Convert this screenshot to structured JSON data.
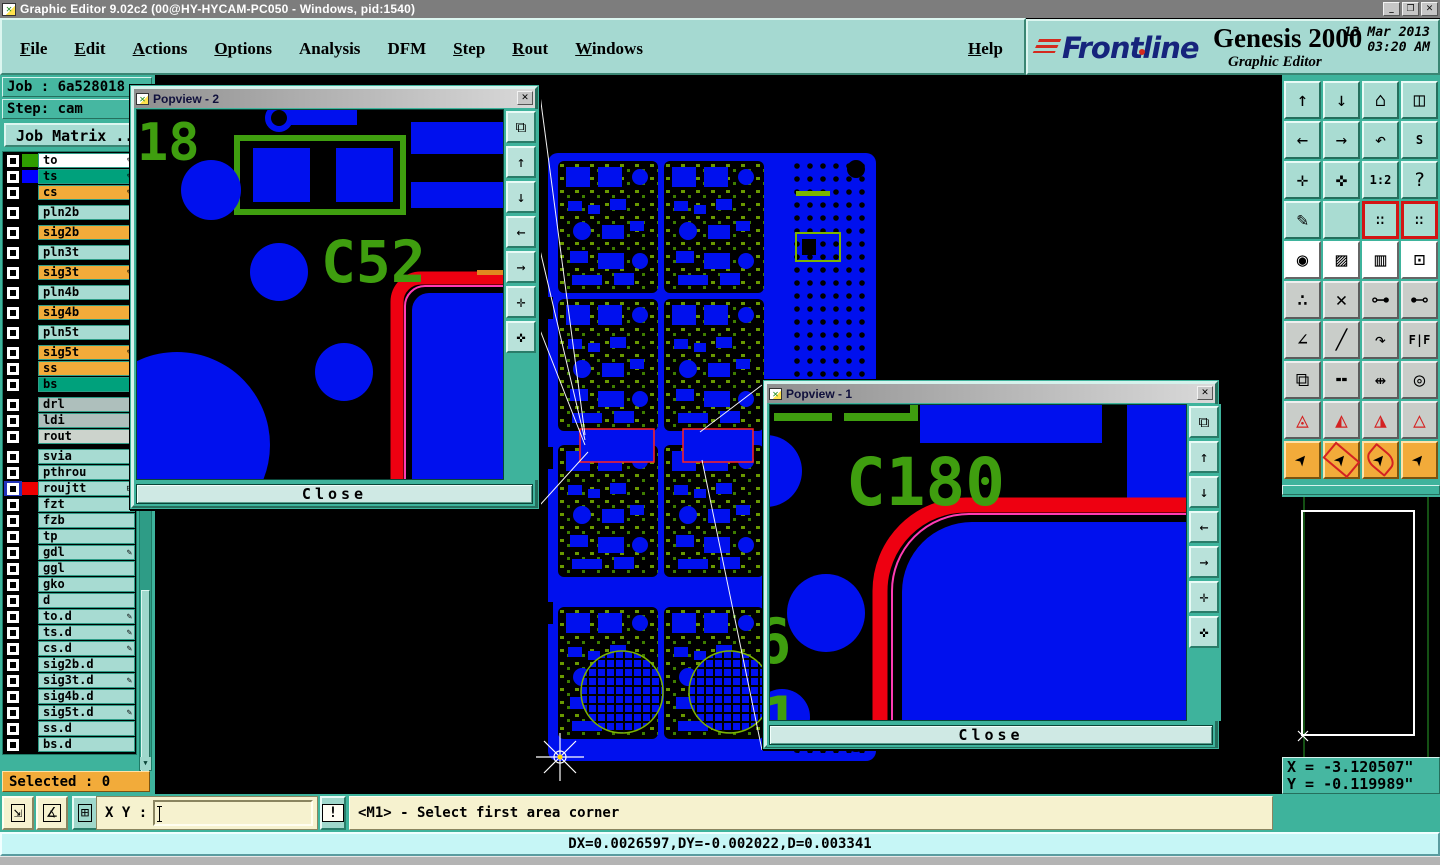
{
  "window": {
    "title": "Graphic Editor 9.02c2 (00@HY-HYCAM-PC050 - Windows, pid:1540)",
    "buttons": {
      "minimize": "_",
      "restore": "❐",
      "close": "✕"
    }
  },
  "menubar": {
    "items": [
      {
        "label": "File",
        "cls": "ul"
      },
      {
        "label": "Edit",
        "cls": "ul"
      },
      {
        "label": "Actions",
        "cls": "ul"
      },
      {
        "label": "Options",
        "cls": "ul"
      },
      {
        "label": "Analysis",
        "cls": ""
      },
      {
        "label": "DFM",
        "cls": ""
      },
      {
        "label": "Step",
        "cls": "ul"
      },
      {
        "label": "Rout",
        "cls": "ul"
      },
      {
        "label": "Windows",
        "cls": "ul"
      }
    ],
    "help_label": "Help"
  },
  "brand": {
    "logo": "Frontline",
    "product": "Genesis 2000",
    "subtitle": "Graphic Editor",
    "datetime": "13 Mar 2013\n   03:20 AM"
  },
  "sidebar": {
    "job_line": "Job : 6a528018",
    "step_line": "Step: cam",
    "job_matrix_label": "Job Matrix ..",
    "selected_label": "Selected : 0",
    "scroll_down_glyph": "▼",
    "layers": [
      {
        "name": "to",
        "cls": "bg-white",
        "swatch": "#2f9e00",
        "mk": "✎"
      },
      {
        "name": "ts",
        "cls": "bg-teal",
        "swatch": "#0000ff",
        "mk": "✎"
      },
      {
        "name": "cs",
        "cls": "bg-orange",
        "swatch": "#000000",
        "mk": "✎"
      },
      {
        "name": "pln2b",
        "cls": "bg-lt gap"
      },
      {
        "name": "sig2b",
        "cls": "bg-orange gap"
      },
      {
        "name": "pln3t",
        "cls": "bg-lt gap"
      },
      {
        "name": "sig3t",
        "cls": "bg-orange gap",
        "mk": "✎"
      },
      {
        "name": "pln4b",
        "cls": "bg-lt gap"
      },
      {
        "name": "sig4b",
        "cls": "bg-orange gap"
      },
      {
        "name": "pln5t",
        "cls": "bg-lt gap"
      },
      {
        "name": "sig5t",
        "cls": "bg-orange gap",
        "mk": "✎"
      },
      {
        "name": "ss",
        "cls": "bg-orange"
      },
      {
        "name": "bs",
        "cls": "bg-teal"
      },
      {
        "name": "drl",
        "cls": "bg-gray gap"
      },
      {
        "name": "ldi",
        "cls": "bg-gray"
      },
      {
        "name": "rout",
        "cls": "bg-rout"
      },
      {
        "name": "svia",
        "cls": "bg-lt gap"
      },
      {
        "name": "pthrou",
        "cls": "bg-lt"
      },
      {
        "name": "roujtt",
        "cls": "bg-lt active",
        "swatch": "#ee0000",
        "mk": "⊞"
      },
      {
        "name": "fzt",
        "cls": "bg-lt"
      },
      {
        "name": "fzb",
        "cls": "bg-lt"
      },
      {
        "name": "tp",
        "cls": "bg-lt"
      },
      {
        "name": "gdl",
        "cls": "bg-lt",
        "mk": "✎"
      },
      {
        "name": "ggl",
        "cls": "bg-lt"
      },
      {
        "name": "gko",
        "cls": "bg-lt"
      },
      {
        "name": "d",
        "cls": "bg-lt"
      },
      {
        "name": "to.d",
        "cls": "bg-lt",
        "mk": "✎"
      },
      {
        "name": "ts.d",
        "cls": "bg-lt",
        "mk": "✎"
      },
      {
        "name": "cs.d",
        "cls": "bg-lt",
        "mk": "✎"
      },
      {
        "name": "sig2b.d",
        "cls": "bg-lt"
      },
      {
        "name": "sig3t.d",
        "cls": "bg-lt",
        "mk": "✎"
      },
      {
        "name": "sig4b.d",
        "cls": "bg-lt"
      },
      {
        "name": "sig5t.d",
        "cls": "bg-lt",
        "mk": "✎"
      },
      {
        "name": "ss.d",
        "cls": "bg-lt"
      },
      {
        "name": "bs.d",
        "cls": "bg-lt"
      }
    ]
  },
  "toolbar": {
    "buttons": [
      {
        "name": "view-up-button",
        "glyph": "↑",
        "cls": "t boxed"
      },
      {
        "name": "view-down-button",
        "glyph": "↓",
        "cls": "t boxed"
      },
      {
        "name": "home-view-button",
        "glyph": "⌂",
        "cls": "t"
      },
      {
        "name": "split-window-xy-button",
        "glyph": "◫",
        "cls": "t"
      },
      {
        "name": "view-left-button",
        "glyph": "←",
        "cls": "t boxed"
      },
      {
        "name": "view-right-button",
        "glyph": "→",
        "cls": "t boxed"
      },
      {
        "name": "previous-view-button",
        "glyph": "↶",
        "cls": "t boxed"
      },
      {
        "name": "serpentine-view-button",
        "glyph": "S",
        "cls": "t sm"
      },
      {
        "name": "zoom-extents-button",
        "glyph": "✛",
        "cls": "t boxed"
      },
      {
        "name": "zoom-center-button",
        "glyph": "✜",
        "cls": "t boxed"
      },
      {
        "name": "zoom-1-2-button",
        "glyph": "1:2",
        "cls": "t sm"
      },
      {
        "name": "context-help-button",
        "glyph": "?",
        "cls": "t boxed"
      },
      {
        "name": "edit-tools-button",
        "glyph": "✎",
        "cls": "t"
      },
      {
        "name": "grid-toggle-button",
        "glyph": "",
        "cls": "t gridbg"
      },
      {
        "name": "net-probe-1-button",
        "glyph": "∷",
        "cls": "t netl"
      },
      {
        "name": "net-probe-2-button",
        "glyph": "∷",
        "cls": "t netl"
      },
      {
        "name": "select-symbol-button",
        "glyph": "◉",
        "cls": "w"
      },
      {
        "name": "measure-objects-button",
        "glyph": "▨",
        "cls": "w"
      },
      {
        "name": "ruler-button",
        "glyph": "▥",
        "cls": "w"
      },
      {
        "name": "select-single-button",
        "glyph": "⊡",
        "cls": "w"
      },
      {
        "name": "chain-select-button",
        "glyph": "∴",
        "cls": "g"
      },
      {
        "name": "delete-feature-button",
        "glyph": "✕",
        "cls": "g"
      },
      {
        "name": "move-feature-button",
        "glyph": "⊶",
        "cls": "g"
      },
      {
        "name": "copy-feature-button",
        "glyph": "⊷",
        "cls": "g"
      },
      {
        "name": "measure-angle-button",
        "glyph": "∠",
        "cls": "g"
      },
      {
        "name": "draw-line-button",
        "glyph": "╱",
        "cls": "g"
      },
      {
        "name": "rotate-feature-button",
        "glyph": "↷",
        "cls": "g"
      },
      {
        "name": "mirror-feature-button",
        "glyph": "F|F",
        "cls": "g sm"
      },
      {
        "name": "duplicate-button",
        "glyph": "⧉",
        "cls": "g"
      },
      {
        "name": "stretch-line-button",
        "glyph": "╍",
        "cls": "g"
      },
      {
        "name": "dimension-button",
        "glyph": "⇹",
        "cls": "g"
      },
      {
        "name": "merge-shapes-button",
        "glyph": "◎",
        "cls": "g"
      },
      {
        "name": "dfm-check-1-button",
        "glyph": "◬",
        "cls": "g tri"
      },
      {
        "name": "dfm-check-2-button",
        "glyph": "◭",
        "cls": "g tri"
      },
      {
        "name": "dfm-check-3-button",
        "glyph": "◮",
        "cls": "g tri"
      },
      {
        "name": "dfm-check-4-button",
        "glyph": "△",
        "cls": "g tri"
      },
      {
        "name": "select-pointer-button",
        "glyph": "➤",
        "cls": "o cur"
      },
      {
        "name": "select-in-rect-button",
        "glyph": "➤",
        "cls": "o cur selrect"
      },
      {
        "name": "select-in-poly-button",
        "glyph": "➤",
        "cls": "o cur selpoly"
      },
      {
        "name": "select-net-button",
        "glyph": "➤",
        "cls": "o cur"
      }
    ]
  },
  "popviews": [
    {
      "title": "Popview - 2",
      "close_label": "Close",
      "close_glyph": "✕",
      "label": "C52",
      "partial_label": "18",
      "tools": [
        {
          "name": "pop-window-button",
          "glyph": "⧉",
          "cls": ""
        },
        {
          "name": "pop-up-button",
          "glyph": "↑",
          "cls": "boxed"
        },
        {
          "name": "pop-down-button",
          "glyph": "↓",
          "cls": "boxed"
        },
        {
          "name": "pop-left-button",
          "glyph": "←",
          "cls": "boxed"
        },
        {
          "name": "pop-right-button",
          "glyph": "→",
          "cls": "boxed"
        },
        {
          "name": "pop-zoom-out-button",
          "glyph": "✛",
          "cls": "boxed"
        },
        {
          "name": "pop-zoom-in-button",
          "glyph": "✜",
          "cls": "boxed"
        }
      ]
    },
    {
      "title": "Popview - 1",
      "close_label": "Close",
      "close_glyph": "✕",
      "label": "C180",
      "partial_label_1": "6",
      "partial_label_2": "1",
      "tools": [
        {
          "name": "pop-window-button",
          "glyph": "⧉",
          "cls": ""
        },
        {
          "name": "pop-up-button",
          "glyph": "↑",
          "cls": "boxed"
        },
        {
          "name": "pop-down-button",
          "glyph": "↓",
          "cls": "boxed"
        },
        {
          "name": "pop-left-button",
          "glyph": "←",
          "cls": "boxed"
        },
        {
          "name": "pop-right-button",
          "glyph": "→",
          "cls": "boxed"
        },
        {
          "name": "pop-zoom-out-button",
          "glyph": "✛",
          "cls": "boxed"
        },
        {
          "name": "pop-zoom-in-button",
          "glyph": "✜",
          "cls": "boxed"
        }
      ]
    }
  ],
  "readout": {
    "x_line": "X = -3.120507\"",
    "y_line": "Y = -0.119989\"",
    "units_label": "Inch"
  },
  "command": {
    "tools": [
      {
        "name": "measure-diagonal-button",
        "glyph": "⇲",
        "cls": ""
      },
      {
        "name": "measure-angle-button",
        "glyph": "∡",
        "cls": ""
      },
      {
        "name": "grid-snap-button",
        "glyph": "⊞",
        "cls": "tealb"
      }
    ],
    "xy_label": "X Y :",
    "input_value": "",
    "alert_glyph": "!",
    "message": "<M1> - Select first area corner"
  },
  "statusbar": {
    "text": "DX=0.0026597,DY=-0.002022,D=0.003341"
  },
  "colors": {
    "ui_teal": "#3eb39c",
    "ui_teal_light": "#a5d9d1",
    "ui_orange": "#f2ab3a",
    "ui_cream": "#f6f2cf",
    "status_cyan": "#c6f6f6",
    "board_copper": "#0010ee",
    "silkscreen_green": "#3f9e0f",
    "trace_red": "#ee0011"
  }
}
